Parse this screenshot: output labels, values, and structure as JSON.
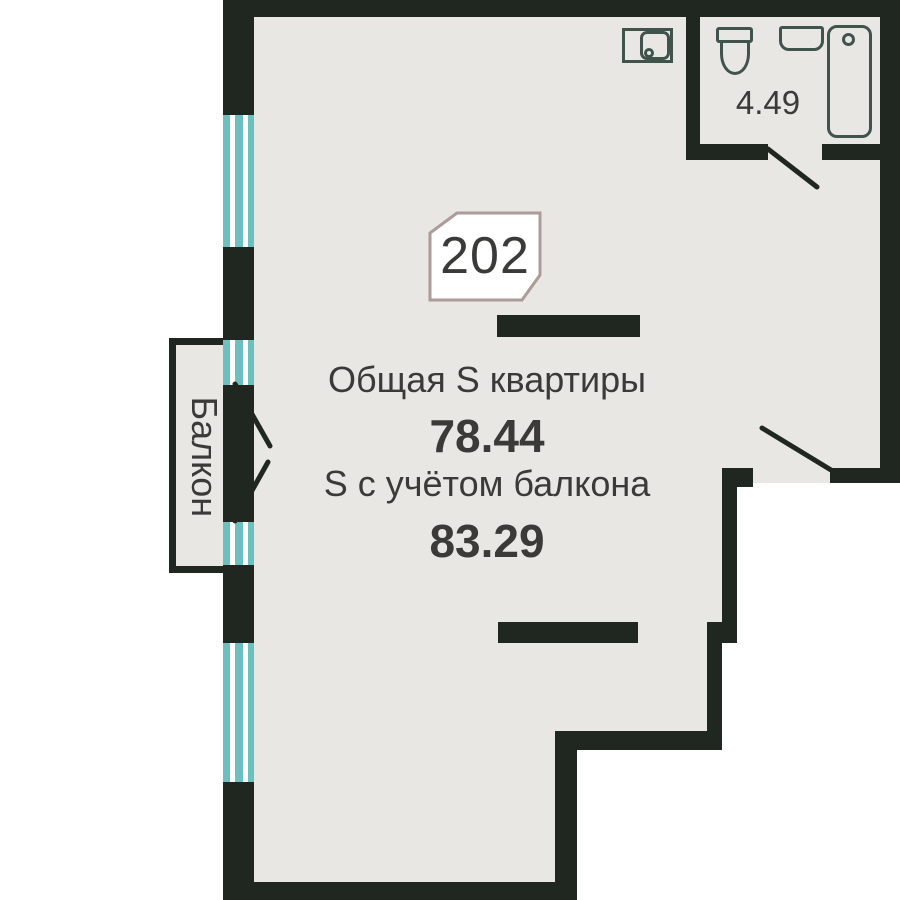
{
  "unit": {
    "number": "202"
  },
  "areas": {
    "total_label": "Общая S квартиры",
    "total_value": "78.44",
    "with_balcony_label": "S с учётом балкона",
    "with_balcony_value": "83.29",
    "bathroom_value": "4.49"
  },
  "labels": {
    "balcony": "Балкон"
  },
  "colors": {
    "wall": "#202720",
    "floor": "#e9e7e4",
    "outside": "#ffffff",
    "window_glass": "#6cc0c0",
    "fixture_outline": "#41534d",
    "badge_border": "#ab9b99",
    "badge_fill": "#ffffff",
    "text": "#3a3a38"
  }
}
